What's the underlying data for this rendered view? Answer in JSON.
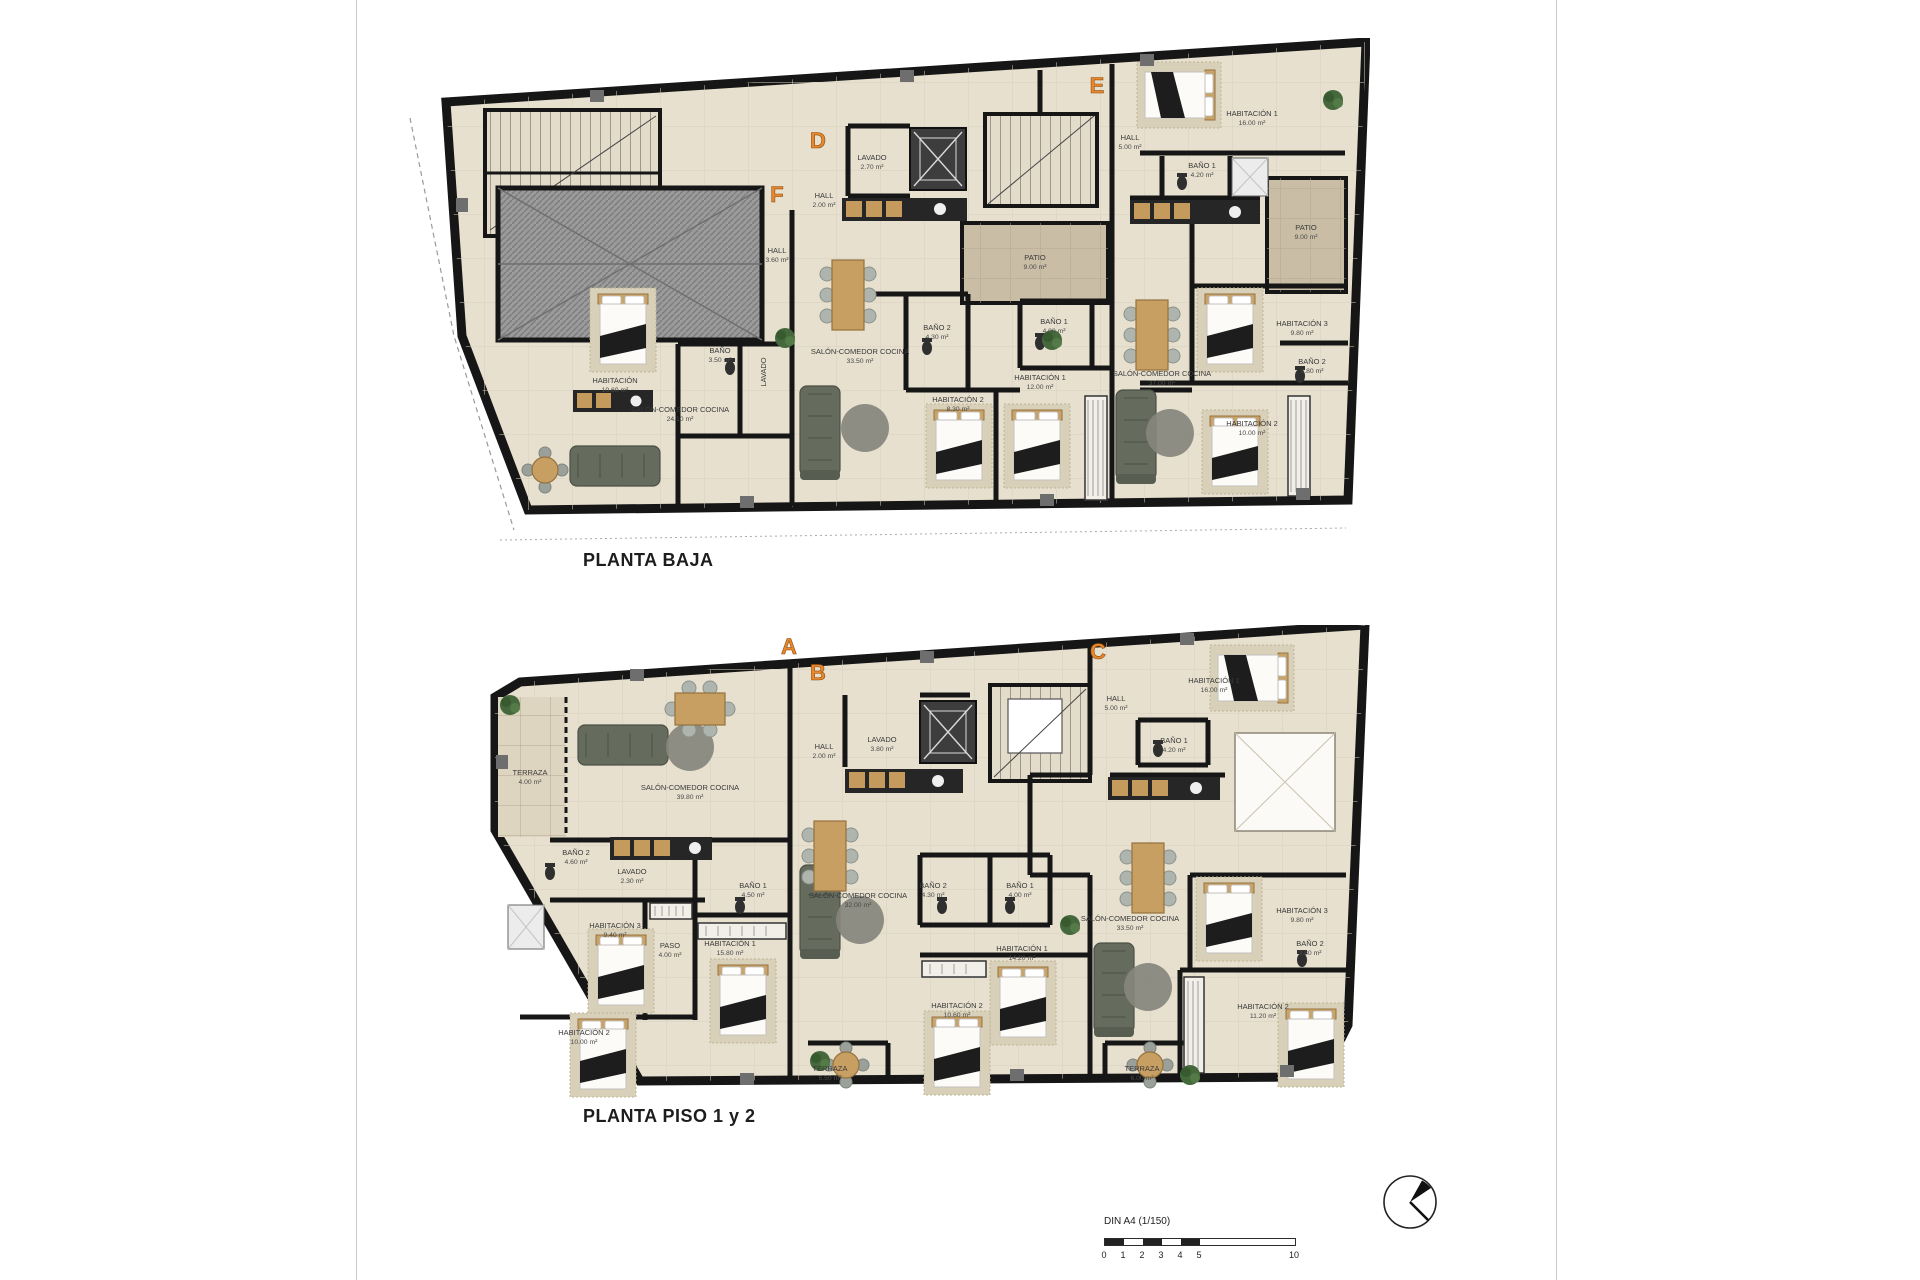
{
  "document": {
    "type": "architectural floor plans",
    "sheet_note": "DIN A4 (1/150)"
  },
  "colors": {
    "accent_orange": "#e8872b",
    "wall_black": "#1a1a1a",
    "floor_beige": "#e7e0cf",
    "patio_tan": "#c9bda6",
    "hatch_gray": "#999999"
  },
  "floors": [
    {
      "id": "planta-baja",
      "title": "PLANTA BAJA",
      "units": [
        {
          "letter": "D",
          "x": 378,
          "y": 110
        },
        {
          "letter": "E",
          "x": 657,
          "y": 55
        },
        {
          "letter": "F",
          "x": 337,
          "y": 164
        }
      ],
      "rooms": [
        {
          "label": "HABITACIÓN",
          "area": "10.60 m²",
          "x": 175,
          "y": 345
        },
        {
          "label": "BAÑO",
          "area": "3.50 m²",
          "x": 280,
          "y": 315
        },
        {
          "label": "LAVADO",
          "area": "",
          "x": 326,
          "y": 334,
          "rot": -90
        },
        {
          "label": "SALÓN-COMEDOR COCINA",
          "area": "24.10 m²",
          "x": 240,
          "y": 374
        },
        {
          "label": "HALL",
          "area": "3.60 m²",
          "x": 337,
          "y": 215
        },
        {
          "label": "LAVADO",
          "area": "2.70 m²",
          "x": 432,
          "y": 122
        },
        {
          "label": "HALL",
          "area": "2.00 m²",
          "x": 384,
          "y": 160
        },
        {
          "label": "PATIO",
          "area": "9.00 m²",
          "x": 595,
          "y": 222
        },
        {
          "label": "BAÑO 2",
          "area": "4.30 m²",
          "x": 497,
          "y": 292
        },
        {
          "label": "BAÑO 1",
          "area": "4.00 m²",
          "x": 614,
          "y": 286
        },
        {
          "label": "HABITACIÓN 1",
          "area": "12.00 m²",
          "x": 600,
          "y": 342
        },
        {
          "label": "HABITACIÓN 2",
          "area": "8.30 m²",
          "x": 518,
          "y": 364
        },
        {
          "label": "SALÓN-COMEDOR COCINA",
          "area": "33.50 m²",
          "x": 420,
          "y": 316
        },
        {
          "label": "HALL",
          "area": "5.00 m²",
          "x": 690,
          "y": 102
        },
        {
          "label": "HABITACIÓN 1",
          "area": "16.00 m²",
          "x": 812,
          "y": 78
        },
        {
          "label": "BAÑO 1",
          "area": "4.20 m²",
          "x": 762,
          "y": 130
        },
        {
          "label": "PATIO",
          "area": "9.00 m²",
          "x": 866,
          "y": 192
        },
        {
          "label": "HABITACIÓN 3",
          "area": "9.80 m²",
          "x": 862,
          "y": 288
        },
        {
          "label": "BAÑO 2",
          "area": "3.80 m²",
          "x": 872,
          "y": 326
        },
        {
          "label": "SALÓN-COMEDOR COCINA",
          "area": "37.00 m²",
          "x": 722,
          "y": 338
        },
        {
          "label": "HABITACIÓN 2",
          "area": "10.00 m²",
          "x": 812,
          "y": 388
        }
      ]
    },
    {
      "id": "planta-piso-1-2",
      "title": "PLANTA PISO 1 y 2",
      "units": [
        {
          "letter": "A",
          "x": 299,
          "y": 29
        },
        {
          "letter": "B",
          "x": 328,
          "y": 55
        },
        {
          "letter": "C",
          "x": 608,
          "y": 34
        }
      ],
      "rooms": [
        {
          "label": "TERRAZA",
          "area": "4.00 m²",
          "x": 40,
          "y": 150
        },
        {
          "label": "SALÓN-COMEDOR COCINA",
          "area": "39.80 m²",
          "x": 200,
          "y": 165
        },
        {
          "label": "BAÑO 2",
          "area": "4.60 m²",
          "x": 86,
          "y": 230
        },
        {
          "label": "LAVADO",
          "area": "2.30 m²",
          "x": 142,
          "y": 249
        },
        {
          "label": "HABITACIÓN 3",
          "area": "9.40 m²",
          "x": 125,
          "y": 303
        },
        {
          "label": "PASO",
          "area": "4.00 m²",
          "x": 180,
          "y": 323
        },
        {
          "label": "BAÑO 1",
          "area": "4.50 m²",
          "x": 263,
          "y": 263
        },
        {
          "label": "HABITACIÓN 1",
          "area": "15.80 m²",
          "x": 240,
          "y": 321
        },
        {
          "label": "HABITACIÓN 2",
          "area": "10.00 m²",
          "x": 94,
          "y": 410
        },
        {
          "label": "HALL",
          "area": "2.00 m²",
          "x": 334,
          "y": 124
        },
        {
          "label": "LAVADO",
          "area": "3.80 m²",
          "x": 392,
          "y": 117
        },
        {
          "label": "SALÓN-COMEDOR COCINA",
          "area": "32.00 m²",
          "x": 368,
          "y": 273
        },
        {
          "label": "BAÑO 2",
          "area": "4.30 m²",
          "x": 443,
          "y": 263
        },
        {
          "label": "BAÑO 1",
          "area": "4.00 m²",
          "x": 530,
          "y": 263
        },
        {
          "label": "HABITACIÓN 1",
          "area": "14.20 m²",
          "x": 532,
          "y": 326
        },
        {
          "label": "HABITACIÓN 2",
          "area": "10.60 m²",
          "x": 467,
          "y": 383
        },
        {
          "label": "TERRAZA",
          "area": "5.50 m²",
          "x": 340,
          "y": 446
        },
        {
          "label": "HALL",
          "area": "5.00 m²",
          "x": 626,
          "y": 76
        },
        {
          "label": "HABITACIÓN 1",
          "area": "16.00 m²",
          "x": 724,
          "y": 58
        },
        {
          "label": "BAÑO 1",
          "area": "4.20 m²",
          "x": 684,
          "y": 118
        },
        {
          "label": "SALÓN-COMEDOR COCINA",
          "area": "33.50 m²",
          "x": 640,
          "y": 296
        },
        {
          "label": "HABITACIÓN 3",
          "area": "9.80 m²",
          "x": 812,
          "y": 288
        },
        {
          "label": "BAÑO 2",
          "area": "3.80 m²",
          "x": 820,
          "y": 321
        },
        {
          "label": "HABITACIÓN 2",
          "area": "11.20 m²",
          "x": 773,
          "y": 384
        },
        {
          "label": "TERRAZA",
          "area": "6.00 m²",
          "x": 652,
          "y": 446
        }
      ]
    }
  ],
  "scale_bar": {
    "label": "DIN A4 (1/150)",
    "ticks": [
      "0",
      "1",
      "2",
      "3",
      "4",
      "5"
    ],
    "end_tick": "10"
  }
}
